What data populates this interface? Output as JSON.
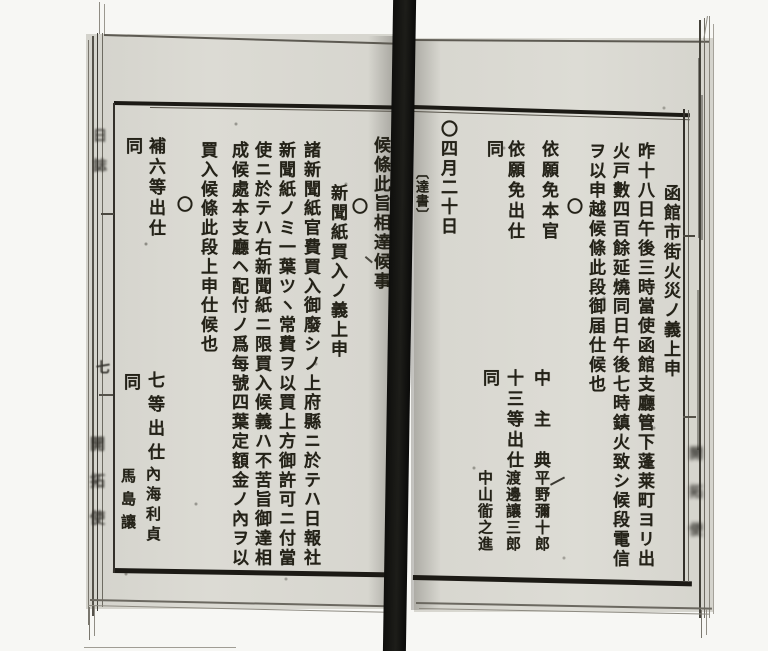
{
  "right_page": {
    "entry1": {
      "title": "函館市街火災ノ義上申",
      "line1": "昨十八日午後三時當使函館支廳管下蓬莱町ヨリ出",
      "line2": "火戸數四百餘延燒同日午後七時鎮火致シ候段電信",
      "line3": "ヲ以申越候條此段御届仕候也"
    },
    "entry2": {
      "marker": "〇",
      "action1": "依願免本官",
      "action2": "依願免出仕",
      "action3": "同",
      "rank1": "中主典",
      "name1": "平野彌十郎",
      "rank2": "十三等出仕",
      "name2": "渡邊讓三郎",
      "rank3": "同",
      "name3": "中山衜之進"
    },
    "entry3": {
      "marker": "〇",
      "date": "四月二十日",
      "section_label": "〔達書〕"
    }
  },
  "left_page": {
    "carryover_text": "候條此旨相達候事",
    "entry4": {
      "marker": "〇",
      "title": "新聞紙買入ノ義上申",
      "line1": "諸新聞紙官費買入御廢シノ上府縣ニ於テハ日報社",
      "line2": "新聞紙ノミ一葉ツヽ常費ヲ以買上方御許可ニ付當",
      "line3": "使ニ於テハ右新聞紙ニ限買入候義ハ不苦旨御達相",
      "line4": "成候處本支廳ヘ配付ノ爲每號四葉定額金ノ內ヲ以",
      "line5": "買入候條此段上申仕候也"
    },
    "entry5": {
      "marker": "〇",
      "action1": "補六等出仕",
      "action2": "同",
      "rank1": "七等出仕",
      "name1": "內海利貞",
      "rank2": "同",
      "name2": "馬島讓"
    }
  },
  "left_margin": {
    "running_title": "日誌",
    "page_number": "七",
    "publisher": "開拓使"
  },
  "right_margin": {
    "publisher_blurred": "開拓使"
  }
}
